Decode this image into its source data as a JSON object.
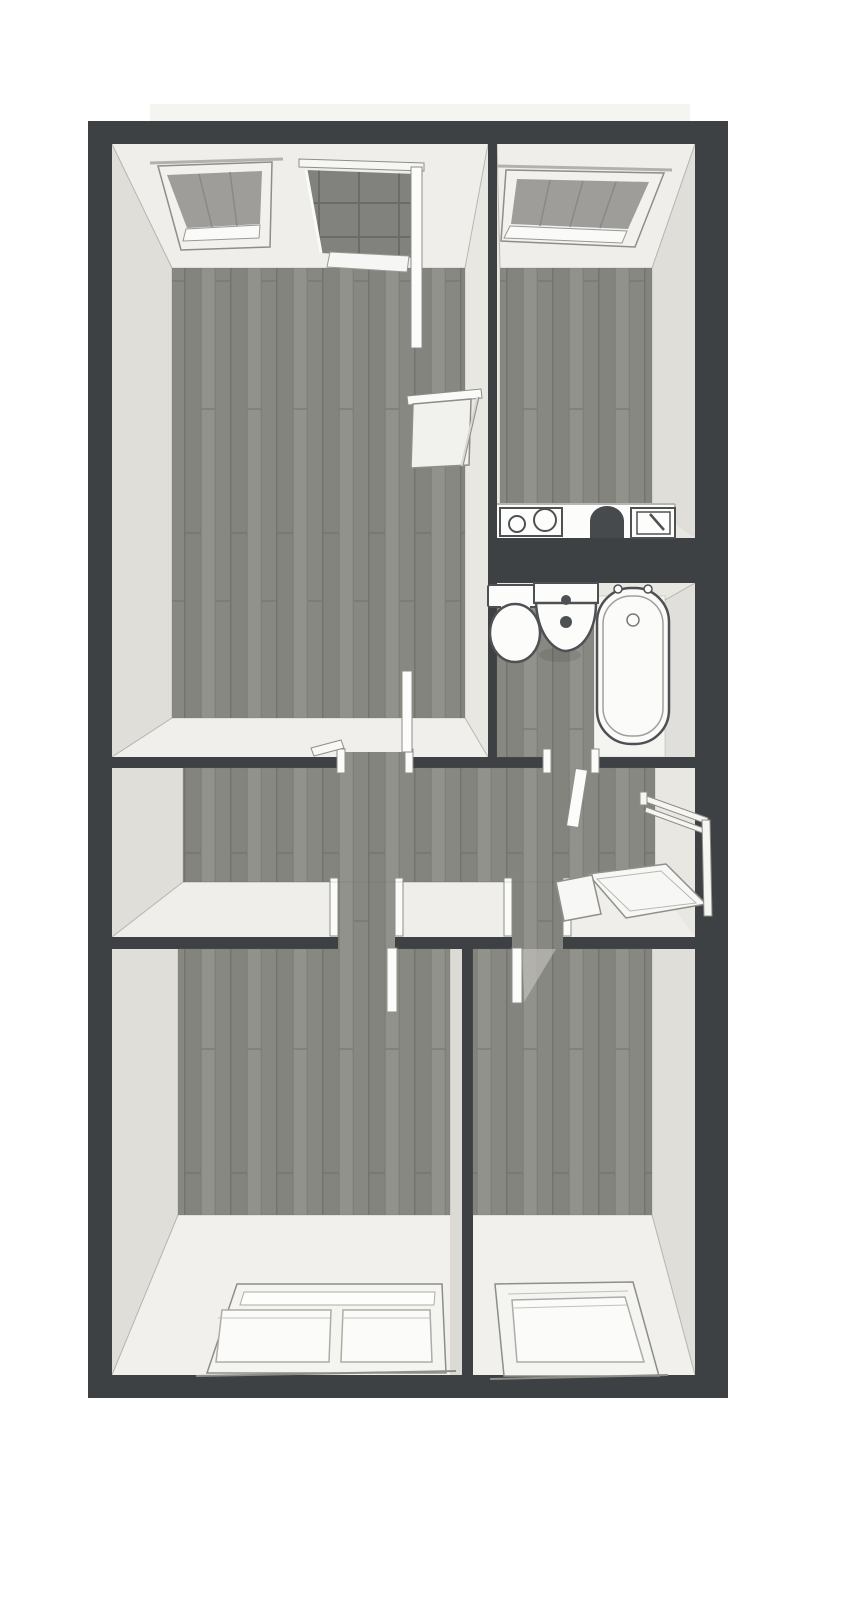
{
  "meta": {
    "type": "floor-plan-3d-render",
    "view": "top-down-perspective"
  },
  "colors": {
    "wall": "#3e4144",
    "interior": "#e9e7e2",
    "interior_bright": "#f2f1ed",
    "roof_strip": "#f4f4f1",
    "divider_face": "#dcdad4",
    "floor_plank": "#8b8b87",
    "plank_light": "#92928d",
    "plank_dark": "#84847f",
    "plank_seam": "#74746e",
    "glass_roof": "#9e9d99",
    "glass_tile": "#81817d",
    "tile_seam": "#6c6c67",
    "fixture_outline": "#4e5154",
    "frame_white": "#fcfcfb",
    "frame_edge": "#8e8d88",
    "sash_edge": "#aeaca6",
    "bath_floor": "#f4f4f1",
    "counter_dark": "#474a4d",
    "door_shadow": "#c8c6c0"
  },
  "rooms": [
    {
      "id": "room-top-left",
      "label": "room-top-left",
      "fixtures": [
        "roof-window",
        "glazed-balcony-door",
        "open-door-leaf",
        "wall-table",
        "doorway-to-hallway"
      ]
    },
    {
      "id": "room-top-right",
      "label": "room-top-right-with-kitchenette",
      "fixtures": [
        "roof-window",
        "cooktop-two-burners",
        "counter-stool",
        "kitchen-sink"
      ]
    },
    {
      "id": "bathroom",
      "label": "bathroom",
      "fixtures": [
        "toilet",
        "wash-basin",
        "bathtub",
        "doorway-to-hallway"
      ]
    },
    {
      "id": "hallway",
      "label": "hallway",
      "fixtures": [
        "staircase-landing",
        "stair-railing",
        "open-door-leaf",
        "doorway-bottom-left-room",
        "doorway-bottom-right-room"
      ]
    },
    {
      "id": "room-bottom-left",
      "label": "room-bottom-left",
      "fixtures": [
        "double-window",
        "open-door-leaf"
      ]
    },
    {
      "id": "room-bottom-right",
      "label": "room-bottom-right",
      "fixtures": [
        "single-window",
        "open-door-leaf"
      ]
    }
  ]
}
